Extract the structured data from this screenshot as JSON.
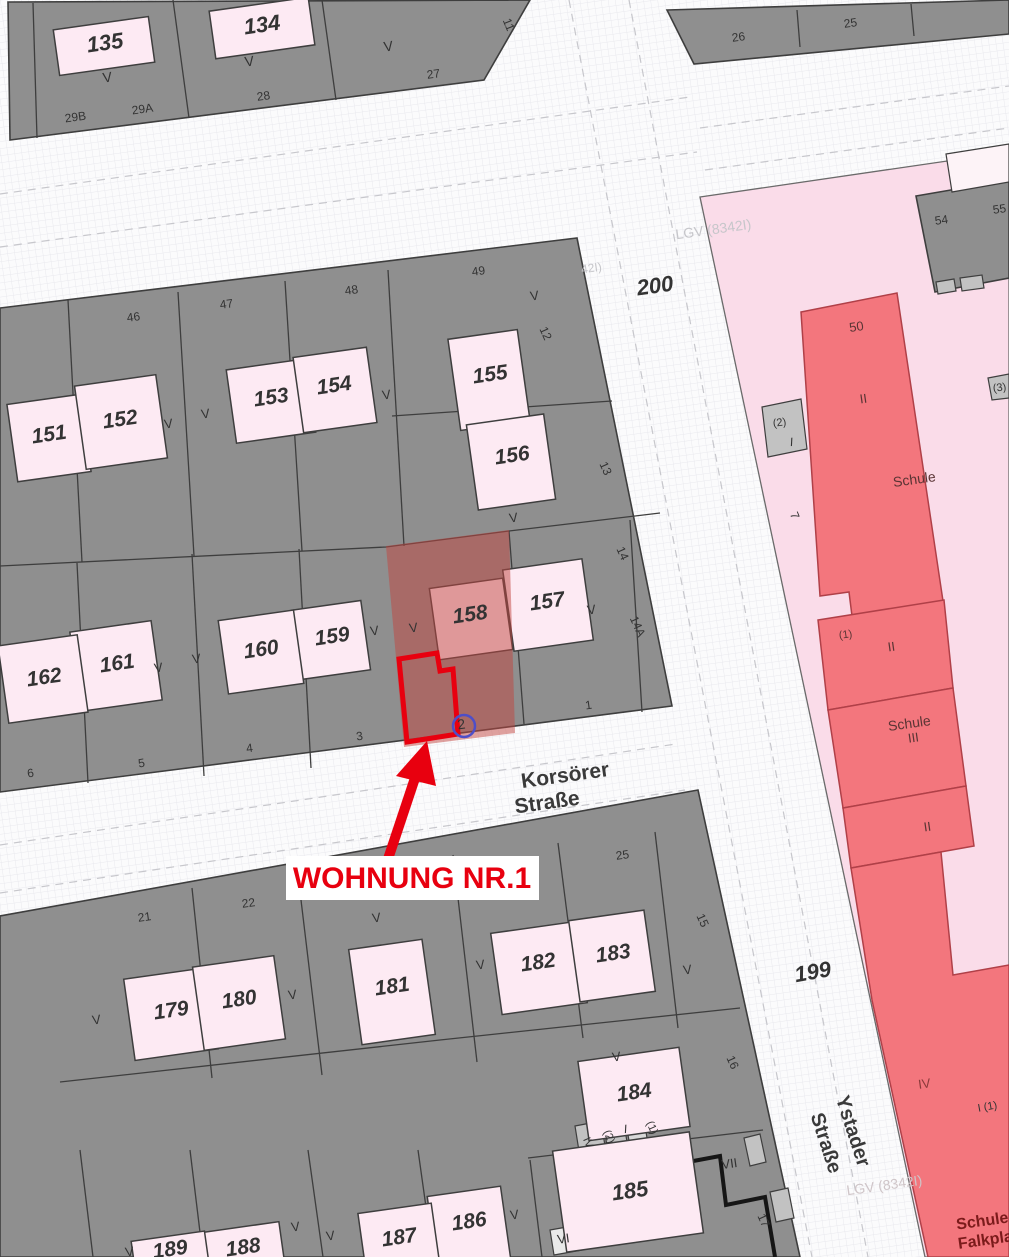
{
  "annotation": {
    "text": "WOHNUNG NR.1",
    "color": "#e8000f"
  },
  "highlight": {
    "parcel": "158",
    "unit_marker": "2"
  },
  "streets": [
    {
      "name": "Korsörer Straße"
    },
    {
      "name": "Ystader Straße"
    }
  ],
  "city_block_numbers": [
    "199",
    "200"
  ],
  "school_label": "Schule",
  "watermark": "LGV (8342I)",
  "map_colors": {
    "block_gray": "#8f8f8f",
    "building_pink": "#fdeaf3",
    "school_ground_pink": "#fadce9",
    "school_red": "#f3767d",
    "highlight_overlay": "#c24540",
    "annotation_red": "#e8000f",
    "circle_blue": "#4e4ec8"
  },
  "labels": [
    {
      "t": "135",
      "x": 106,
      "y": 50,
      "s": 22,
      "it": 1,
      "b": 1
    },
    {
      "t": "134",
      "x": 263,
      "y": 32,
      "s": 22,
      "it": 1,
      "b": 1
    },
    {
      "t": "V",
      "x": 108,
      "y": 82,
      "s": 14
    },
    {
      "t": "V",
      "x": 250,
      "y": 66,
      "s": 14
    },
    {
      "t": "V",
      "x": 389,
      "y": 51,
      "s": 14
    },
    {
      "t": "29B",
      "x": 76,
      "y": 121,
      "s": 12
    },
    {
      "t": "29A",
      "x": 143,
      "y": 113,
      "s": 12
    },
    {
      "t": "28",
      "x": 264,
      "y": 100,
      "s": 12
    },
    {
      "t": "27",
      "x": 434,
      "y": 78,
      "s": 12
    },
    {
      "t": "11",
      "x": 505,
      "y": 26,
      "r": 68,
      "s": 12
    },
    {
      "t": "26",
      "x": 739,
      "y": 41,
      "s": 12
    },
    {
      "t": "25",
      "x": 851,
      "y": 27,
      "s": 12
    },
    {
      "t": "46",
      "x": 134,
      "y": 321,
      "s": 12
    },
    {
      "t": "47",
      "x": 227,
      "y": 308,
      "s": 12
    },
    {
      "t": "48",
      "x": 352,
      "y": 294,
      "s": 12
    },
    {
      "t": "49",
      "x": 479,
      "y": 275,
      "s": 12
    },
    {
      "t": "151",
      "x": 50,
      "y": 441,
      "s": 21,
      "it": 1,
      "b": 1
    },
    {
      "t": "152",
      "x": 121,
      "y": 426,
      "s": 21,
      "it": 1,
      "b": 1
    },
    {
      "t": "153",
      "x": 272,
      "y": 404,
      "s": 21,
      "it": 1,
      "b": 1
    },
    {
      "t": "154",
      "x": 335,
      "y": 392,
      "s": 21,
      "it": 1,
      "b": 1
    },
    {
      "t": "155",
      "x": 491,
      "y": 381,
      "s": 21,
      "it": 1,
      "b": 1
    },
    {
      "t": "156",
      "x": 513,
      "y": 462,
      "s": 21,
      "it": 1,
      "b": 1
    },
    {
      "t": "V",
      "x": 169,
      "y": 428,
      "s": 13
    },
    {
      "t": "V",
      "x": 206,
      "y": 418,
      "s": 13
    },
    {
      "t": "V",
      "x": 387,
      "y": 399,
      "s": 13
    },
    {
      "t": "V",
      "x": 535,
      "y": 300,
      "s": 13
    },
    {
      "t": "V",
      "x": 514,
      "y": 522,
      "s": 13
    },
    {
      "t": "12",
      "x": 542,
      "y": 335,
      "r": 66,
      "s": 12
    },
    {
      "t": "13",
      "x": 602,
      "y": 470,
      "r": 66,
      "s": 12
    },
    {
      "t": "200",
      "x": 656,
      "y": 293,
      "s": 22,
      "it": 1,
      "b": 1
    },
    {
      "t": "LGV (8342I)",
      "x": 714,
      "y": 234,
      "s": 14,
      "c": "#c6c6ca"
    },
    {
      "t": "42I)",
      "x": 592,
      "y": 272,
      "s": 12,
      "c": "#c6c6ca"
    },
    {
      "t": "162",
      "x": 45,
      "y": 684,
      "s": 21,
      "it": 1,
      "b": 1
    },
    {
      "t": "161",
      "x": 118,
      "y": 670,
      "s": 21,
      "it": 1,
      "b": 1
    },
    {
      "t": "160",
      "x": 262,
      "y": 656,
      "s": 21,
      "it": 1,
      "b": 1
    },
    {
      "t": "159",
      "x": 333,
      "y": 643,
      "s": 21,
      "it": 1,
      "b": 1
    },
    {
      "t": "158",
      "x": 471,
      "y": 621,
      "s": 21,
      "it": 1,
      "b": 1
    },
    {
      "t": "157",
      "x": 548,
      "y": 608,
      "s": 21,
      "it": 1,
      "b": 1
    },
    {
      "t": "V",
      "x": 159,
      "y": 672,
      "s": 13
    },
    {
      "t": "V",
      "x": 197,
      "y": 663,
      "s": 13
    },
    {
      "t": "V",
      "x": 375,
      "y": 635,
      "s": 13
    },
    {
      "t": "V",
      "x": 414,
      "y": 632,
      "s": 13
    },
    {
      "t": "V",
      "x": 592,
      "y": 614,
      "s": 13
    },
    {
      "t": "6",
      "x": 31,
      "y": 777,
      "s": 12
    },
    {
      "t": "5",
      "x": 142,
      "y": 767,
      "s": 12
    },
    {
      "t": "4",
      "x": 250,
      "y": 752,
      "s": 12
    },
    {
      "t": "3",
      "x": 360,
      "y": 740,
      "s": 12
    },
    {
      "t": "1",
      "x": 589,
      "y": 709,
      "s": 12
    },
    {
      "t": "14",
      "x": 619,
      "y": 555,
      "r": 66,
      "s": 12
    },
    {
      "t": "14A",
      "x": 634,
      "y": 628,
      "r": 66,
      "s": 12
    },
    {
      "t": "2",
      "x": 462,
      "y": 729,
      "s": 14
    },
    {
      "t": "Korsörer",
      "x": 566,
      "y": 782,
      "s": 21,
      "b": 1,
      "c": "#3a3a3a"
    },
    {
      "t": "Straße",
      "x": 548,
      "y": 809,
      "s": 21,
      "b": 1,
      "c": "#3a3a3a"
    },
    {
      "t": "Ystader",
      "x": 847,
      "y": 1133,
      "r": 72,
      "s": 20,
      "b": 1,
      "c": "#3a3a3a"
    },
    {
      "t": "Straße",
      "x": 820,
      "y": 1145,
      "r": 72,
      "s": 20,
      "b": 1,
      "c": "#3a3a3a"
    },
    {
      "t": "199",
      "x": 814,
      "y": 979,
      "r": -10,
      "s": 22,
      "it": 1,
      "b": 1
    },
    {
      "t": "21",
      "x": 145,
      "y": 921,
      "s": 12
    },
    {
      "t": "22",
      "x": 249,
      "y": 907,
      "s": 12
    },
    {
      "t": "25",
      "x": 623,
      "y": 859,
      "s": 12
    },
    {
      "t": "15",
      "x": 699,
      "y": 922,
      "r": 66,
      "s": 12
    },
    {
      "t": "16",
      "x": 729,
      "y": 1064,
      "r": 66,
      "s": 12
    },
    {
      "t": "17",
      "x": 760,
      "y": 1222,
      "r": 66,
      "s": 12
    },
    {
      "t": "179",
      "x": 172,
      "y": 1017,
      "s": 21,
      "it": 1,
      "b": 1
    },
    {
      "t": "180",
      "x": 240,
      "y": 1006,
      "s": 21,
      "it": 1,
      "b": 1
    },
    {
      "t": "181",
      "x": 393,
      "y": 993,
      "s": 21,
      "it": 1,
      "b": 1
    },
    {
      "t": "182",
      "x": 539,
      "y": 969,
      "s": 21,
      "it": 1,
      "b": 1
    },
    {
      "t": "183",
      "x": 614,
      "y": 960,
      "s": 21,
      "it": 1,
      "b": 1
    },
    {
      "t": "184",
      "x": 635,
      "y": 1099,
      "s": 21,
      "it": 1,
      "b": 1
    },
    {
      "t": "185",
      "x": 631,
      "y": 1198,
      "s": 22,
      "it": 1,
      "b": 1
    },
    {
      "t": "186",
      "x": 470,
      "y": 1228,
      "s": 21,
      "it": 1,
      "b": 1
    },
    {
      "t": "187",
      "x": 400,
      "y": 1244,
      "s": 21,
      "it": 1,
      "b": 1
    },
    {
      "t": "188",
      "x": 244,
      "y": 1254,
      "s": 21,
      "it": 1,
      "b": 1
    },
    {
      "t": "189",
      "x": 171,
      "y": 1256,
      "s": 21,
      "it": 1,
      "b": 1
    },
    {
      "t": "V",
      "x": 97,
      "y": 1024,
      "s": 13
    },
    {
      "t": "V",
      "x": 293,
      "y": 999,
      "s": 13
    },
    {
      "t": "V",
      "x": 377,
      "y": 922,
      "s": 13
    },
    {
      "t": "V",
      "x": 481,
      "y": 969,
      "s": 13
    },
    {
      "t": "V",
      "x": 688,
      "y": 974,
      "s": 13
    },
    {
      "t": "V",
      "x": 617,
      "y": 1061,
      "s": 13
    },
    {
      "t": "V",
      "x": 130,
      "y": 1256,
      "s": 13
    },
    {
      "t": "V",
      "x": 296,
      "y": 1231,
      "s": 13
    },
    {
      "t": "V",
      "x": 331,
      "y": 1240,
      "s": 13
    },
    {
      "t": "V",
      "x": 515,
      "y": 1219,
      "s": 13
    },
    {
      "t": "IV",
      "x": 585,
      "y": 1144,
      "r": 66,
      "s": 11
    },
    {
      "t": "(2)",
      "x": 606,
      "y": 1138,
      "r": 66,
      "s": 11
    },
    {
      "t": "I",
      "x": 626,
      "y": 1133,
      "s": 12,
      "it": 1
    },
    {
      "t": "(1)",
      "x": 649,
      "y": 1129,
      "r": 66,
      "s": 11
    },
    {
      "t": "VI",
      "x": 564,
      "y": 1243,
      "s": 13
    },
    {
      "t": "VII",
      "x": 730,
      "y": 1168,
      "s": 13
    },
    {
      "t": "50",
      "x": 857,
      "y": 331,
      "s": 13,
      "c": "#5a3434"
    },
    {
      "t": "II",
      "x": 864,
      "y": 403,
      "s": 13,
      "c": "#5a3434"
    },
    {
      "t": "Schule",
      "x": 915,
      "y": 484,
      "s": 14,
      "c": "#5a3434"
    },
    {
      "t": "(2)",
      "x": 780,
      "y": 426,
      "s": 11
    },
    {
      "t": "I",
      "x": 792,
      "y": 446,
      "s": 12,
      "it": 1
    },
    {
      "t": "7",
      "x": 791,
      "y": 517,
      "r": 68,
      "s": 12
    },
    {
      "t": "(3)",
      "x": 1000,
      "y": 391,
      "s": 11
    },
    {
      "t": "54",
      "x": 942,
      "y": 224,
      "s": 12
    },
    {
      "t": "55",
      "x": 1000,
      "y": 213,
      "s": 12
    },
    {
      "t": "(1)",
      "x": 846,
      "y": 638,
      "s": 11,
      "c": "#5a3434"
    },
    {
      "t": "II",
      "x": 892,
      "y": 651,
      "s": 13,
      "c": "#5a3434"
    },
    {
      "t": "Schule",
      "x": 910,
      "y": 728,
      "s": 14,
      "c": "#5a3434"
    },
    {
      "t": "III",
      "x": 914,
      "y": 742,
      "s": 13,
      "c": "#5a3434"
    },
    {
      "t": "II",
      "x": 928,
      "y": 831,
      "s": 13,
      "c": "#5a3434"
    },
    {
      "t": "IV",
      "x": 925,
      "y": 1088,
      "s": 13,
      "c": "#8a3a3a"
    },
    {
      "t": "I  (1)",
      "x": 988,
      "y": 1110,
      "r": -10,
      "s": 11
    },
    {
      "t": "Schule",
      "x": 983,
      "y": 1226,
      "s": 16,
      "b": 1,
      "c": "#7b1b1b"
    },
    {
      "t": "Falkpla",
      "x": 986,
      "y": 1245,
      "s": 16,
      "b": 1,
      "c": "#7b1b1b"
    },
    {
      "t": "LGV (8342I)",
      "x": 885,
      "y": 1190,
      "s": 14,
      "c": "#cfc5c8"
    }
  ]
}
